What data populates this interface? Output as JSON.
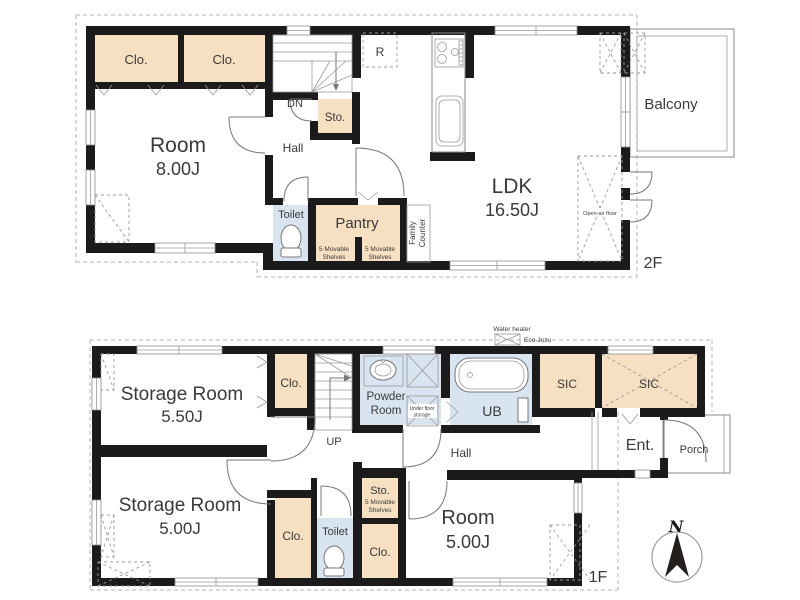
{
  "title": "Two-story residential floor plan",
  "colors": {
    "wall": "#1b1b1b",
    "closet_fill": "#f7dfc2",
    "wet_area_fill": "#d9e4f1",
    "line": "#8a8a8a",
    "dashed": "#b3b3b3",
    "text": "#3a3a3a"
  },
  "floor2": {
    "floor_label": "2F",
    "clo_left": "Clo.",
    "clo_right": "Clo.",
    "room_name": "Room",
    "room_size": "8.00J",
    "dn": "DN",
    "sto": "Sto.",
    "hall": "Hall",
    "fridge": "R",
    "toilet": "Toilet",
    "pantry": "Pantry",
    "shelf1_l1": "5 Movable",
    "shelf1_l2": "Shelves",
    "shelf2_l1": "5 Movable",
    "shelf2_l2": "Shelves",
    "family_l1": "Family",
    "family_l2": "Counter",
    "ldk_name": "LDK",
    "ldk_size": "16.50J",
    "open_air": "Open-air floor",
    "balcony": "Balcony"
  },
  "floor1": {
    "floor_label": "1F",
    "storage_a_name": "Storage Room",
    "storage_a_size": "5.50J",
    "clo_top": "Clo.",
    "up": "UP",
    "powder_l1": "Powder",
    "powder_l2": "Room",
    "underfloor_l1": "Under floor",
    "underfloor_l2": "storage",
    "ub": "UB",
    "heater_l1": "Water heater",
    "heater_l2": "Eco-Jozu",
    "sic_left": "SIC",
    "sic_right": "SIC",
    "ent": "Ent.",
    "porch": "Porch",
    "hall": "Hall",
    "storage_b_name": "Storage Room",
    "storage_b_size": "5.00J",
    "sto": "Sto.",
    "shelf_l1": "5 Movable",
    "shelf_l2": "Shelves",
    "clo_mid": "Clo.",
    "clo_right": "Clo.",
    "toilet": "Toilet",
    "room_name": "Room",
    "room_size": "5.00J",
    "compass_north": "N"
  }
}
